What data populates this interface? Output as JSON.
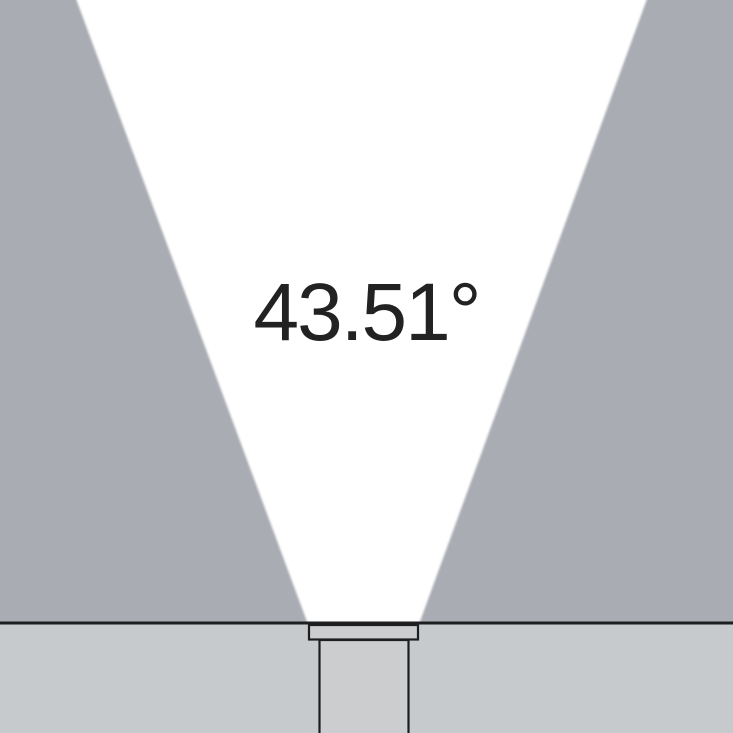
{
  "diagram": {
    "angle_label": "43.51°",
    "angle_value_degrees": 43.51,
    "description": "luminaire-beam-angle-diagram"
  },
  "colors": {
    "background_upper": "#a9acb3",
    "background_lower": "#c7cacd",
    "beam_white": "#ffffff",
    "outline_dark": "#1c1e20",
    "fixture_fill": "#cbcdcf",
    "label_text": "#222222"
  }
}
